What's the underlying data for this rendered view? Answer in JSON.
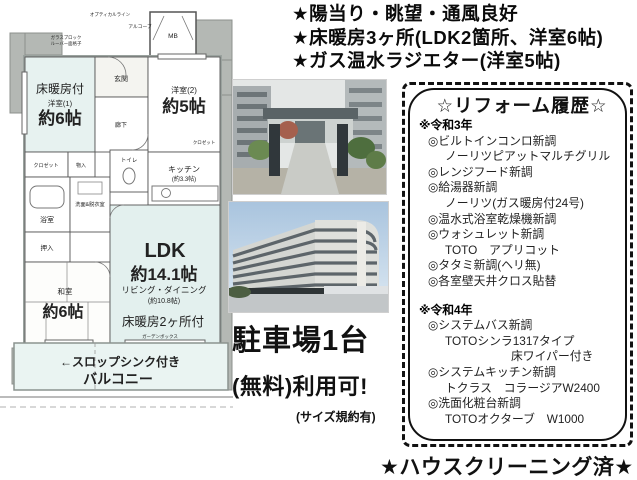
{
  "features": {
    "line1": "★陽当り・眺望・通風良好",
    "line2": "★床暖房3ヶ所(LDK2箇所、洋室6帖)",
    "line3": "★ガス温水ラジエター(洋室5帖)"
  },
  "floorplan": {
    "optical_line": "オプティカルライン",
    "alcove": "アルコーブ",
    "glass_block": "ガラスブロック",
    "louver": "ルーバー面格子",
    "mb": "MB",
    "heated_tag": "床暖房付",
    "western1": "洋室(1)",
    "western1_size": "約6帖",
    "western2": "洋室(2)",
    "western2_size": "約5帖",
    "entrance": "玄関",
    "hall": "廊下",
    "closet1": "クロゼット",
    "storage": "物入",
    "closet2": "クロゼット",
    "bath": "浴室",
    "washroom": "洗面&脱衣室",
    "toilet": "トイレ",
    "kitchen": "キッチン",
    "kitchen_size": "(約3.3帖)",
    "oshiire": "押入",
    "japanese": "和室",
    "japanese_size": "約6帖",
    "ldk": "LDK",
    "ldk_size": "約14.1帖",
    "living": "リビング・ダイニング",
    "living_size": "(約10.8帖)",
    "floor_heat2": "床暖房2ヶ所付",
    "garden_box": "ガーデンボックス",
    "slop_sink": "←スロップシンク付き",
    "balcony": "バルコニー"
  },
  "parking": {
    "line1": "駐車場1台",
    "line2": "(無料)利用可!",
    "line3": "(サイズ規約有)"
  },
  "reform": {
    "title": "☆リフォーム履歴☆",
    "lines": [
      "※令和3年",
      "◎ビルトインコンロ新調",
      "ノーリツピアットマルチグリル",
      "◎レンジフード新調",
      "◎給湯器新調",
      "ノーリツ(ガス暖房付24号)",
      "◎温水式浴室乾燥機新調",
      "◎ウォシュレット新調",
      "TOTO　アプリコット",
      "◎タタミ新調(ヘリ無)",
      "◎各室壁天井クロス貼替",
      "※令和4年",
      "◎システムバス新調",
      "TOTOシンラ1317タイプ",
      "床ワイパー付き",
      "◎システムキッチン新調",
      "トクラス　コラージアW2400",
      "◎洗面化粧台新調",
      "TOTOオクターブ　W1000"
    ]
  },
  "footer": {
    "cleaning": "★ハウスクリーニング済★"
  }
}
